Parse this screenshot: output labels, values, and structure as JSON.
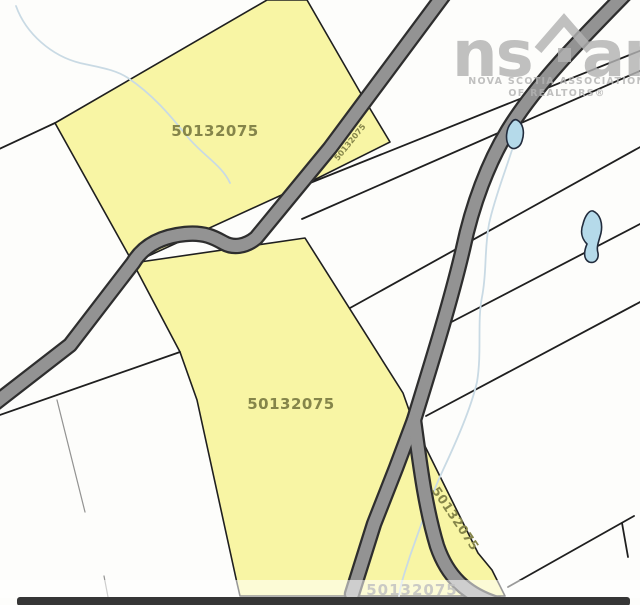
{
  "map": {
    "labels": {
      "top": "50132075",
      "middle": "50132075",
      "sliver": "50132075",
      "strip": "50132075",
      "bottom": "50132075"
    },
    "watermark": {
      "left": "ns",
      "right": "ar",
      "caption_line1": "NOVA SCOTIA ASSOCIATION",
      "caption_line2": "OF REALTORS®"
    },
    "colors": {
      "parcel_fill": "#f8f5a4",
      "road_fill": "#939393",
      "road_casing": "#2e2e2e",
      "boundary": "#1f1f1f",
      "water_fill": "#b5daea",
      "stream": "#c9dae4",
      "label": "#85854a",
      "watermark": "#b3b3b3",
      "bottom_bar": "#363636",
      "bottom_label": "#c2c2c2"
    }
  }
}
